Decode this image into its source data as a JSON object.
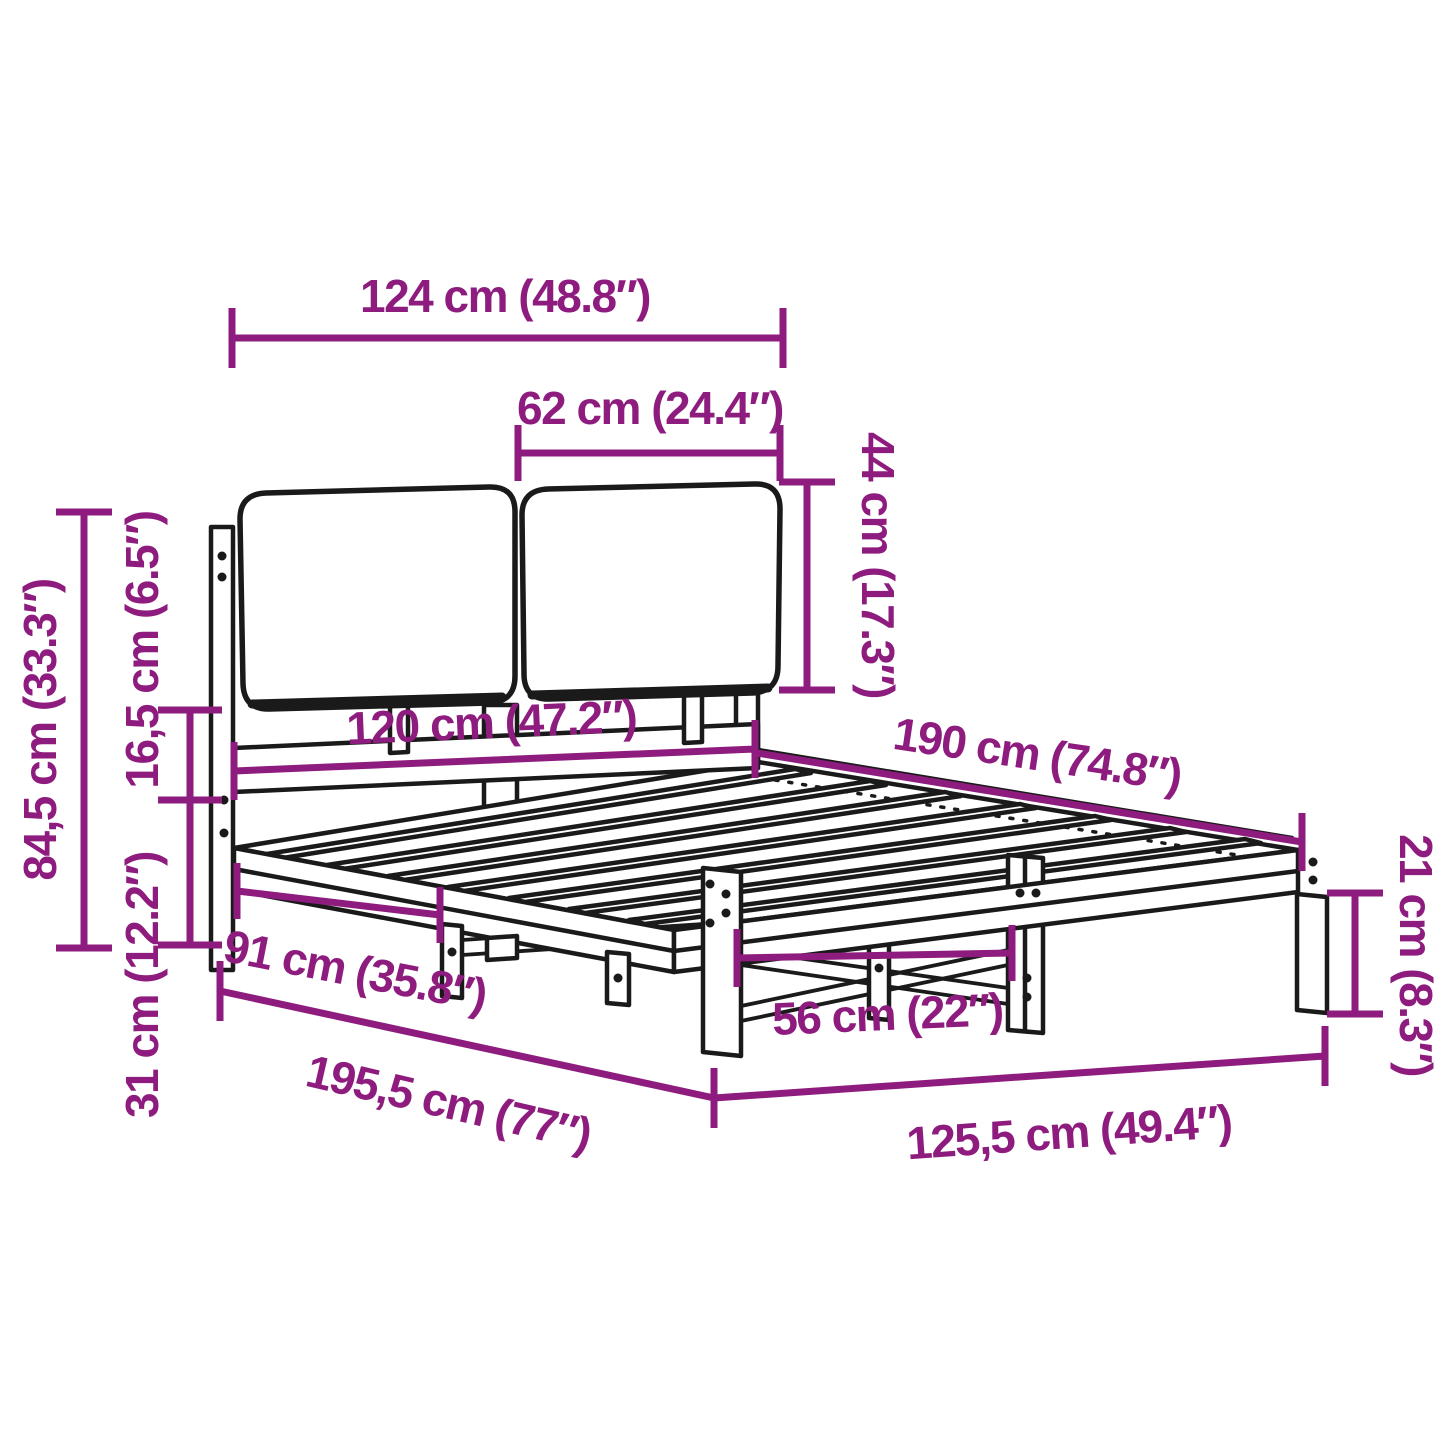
{
  "diagram": {
    "type": "product-dimension-diagram",
    "subject": "bed frame with headboard cushions",
    "colors": {
      "dimension_accent": "#8E1C7E",
      "line_art": "#1a1a1a",
      "background": "#ffffff"
    },
    "dimensions": [
      {
        "id": "headboard-total-width",
        "cm": "124 cm",
        "inches": "48.8″",
        "label": "124 cm (48.8″)"
      },
      {
        "id": "cushion-width",
        "cm": "62 cm",
        "inches": "24.4″",
        "label": "62 cm (24.4″)"
      },
      {
        "id": "cushion-height",
        "cm": "44 cm",
        "inches": "17.3″",
        "label": "44 cm (17.3″)"
      },
      {
        "id": "bed-width",
        "cm": "120 cm",
        "inches": "47.2″",
        "label": "120 cm (47.2″)"
      },
      {
        "id": "bed-length",
        "cm": "190 cm",
        "inches": "74.8″",
        "label": "190 cm (74.8″)"
      },
      {
        "id": "headboard-total-height",
        "cm": "84,5 cm",
        "inches": "33.3″",
        "label": "84,5 cm (33.3″)"
      },
      {
        "id": "cushion-to-frame-height",
        "cm": "16,5 cm",
        "inches": "6.5″",
        "label": "16,5 cm (6.5″)"
      },
      {
        "id": "frame-height",
        "cm": "31 cm",
        "inches": "12.2″",
        "label": "31 cm (12.2″)"
      },
      {
        "id": "headboard-to-center-leg",
        "cm": "91 cm",
        "inches": "35.8″",
        "label": "91 cm (35.8″)"
      },
      {
        "id": "center-leg-span",
        "cm": "56 cm",
        "inches": "22″",
        "label": "56 cm (22″)"
      },
      {
        "id": "total-length",
        "cm": "195,5 cm",
        "inches": "77″",
        "label": "195,5 cm (77″)"
      },
      {
        "id": "total-width",
        "cm": "125,5 cm",
        "inches": "49.4″",
        "label": "125,5 cm (49.4″)"
      },
      {
        "id": "leg-height",
        "cm": "21 cm",
        "inches": "8.3″",
        "label": "21 cm (8.3″)"
      }
    ]
  }
}
